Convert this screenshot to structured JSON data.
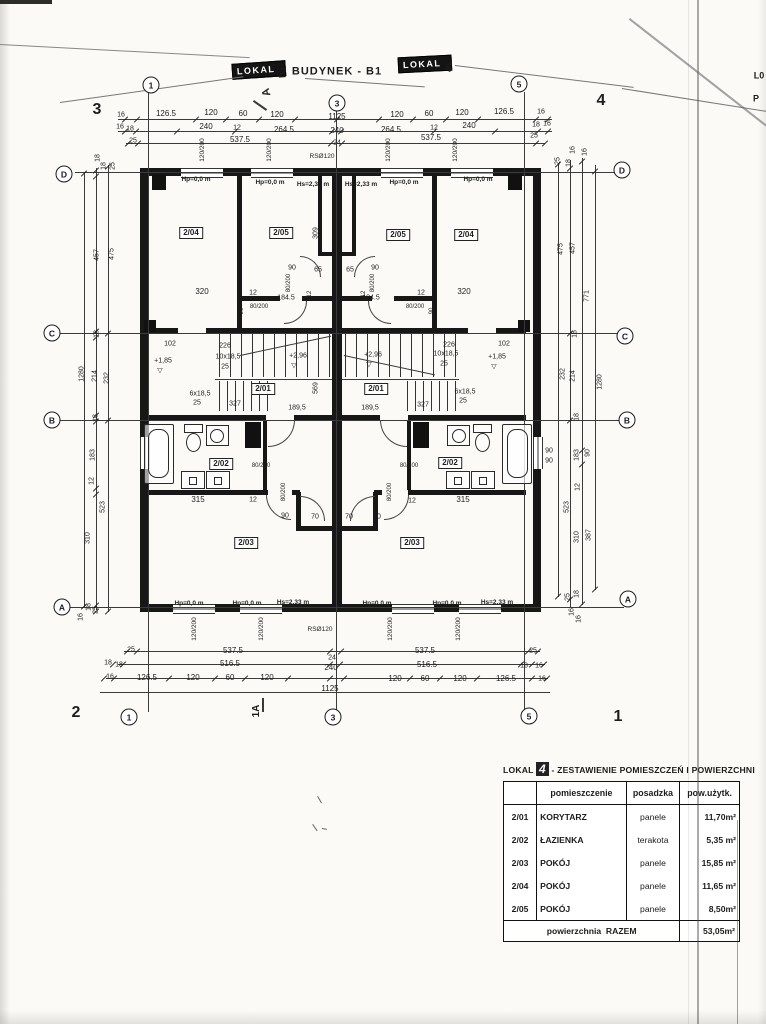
{
  "page": {
    "title": "BUDYNEK - B1"
  },
  "badges": {
    "left": {
      "word": "LOKAL",
      "num": "2"
    },
    "right": {
      "word": "LOKAL",
      "num": "4"
    }
  },
  "axes": [
    {
      "t": "1",
      "x": 151,
      "y": 85
    },
    {
      "t": "3",
      "x": 337,
      "y": 103
    },
    {
      "t": "5",
      "x": 519,
      "y": 84
    },
    {
      "t": "1",
      "x": 129,
      "y": 717
    },
    {
      "t": "3",
      "x": 333,
      "y": 717
    },
    {
      "t": "5",
      "x": 529,
      "y": 716
    },
    {
      "t": "D",
      "x": 64,
      "y": 174
    },
    {
      "t": "C",
      "x": 52,
      "y": 333
    },
    {
      "t": "B",
      "x": 52,
      "y": 420
    },
    {
      "t": "A",
      "x": 62,
      "y": 607
    },
    {
      "t": "D",
      "x": 622,
      "y": 170
    },
    {
      "t": "C",
      "x": 625,
      "y": 336
    },
    {
      "t": "B",
      "x": 627,
      "y": 420
    },
    {
      "t": "A",
      "x": 628,
      "y": 599
    }
  ],
  "table": {
    "title_prefix": "LOKAL",
    "title_num": "4",
    "title_rest": "- ZESTAWIENIE POMIESZCZEŃ I POWIERZCHNI",
    "headers": [
      "",
      "pomieszczenie",
      "posadzka",
      "pow.użytk."
    ],
    "rows": [
      [
        "2/01",
        "KORYTARZ",
        "panele",
        "11,70m²"
      ],
      [
        "2/02",
        "ŁAZIENKA",
        "terakota",
        "5,35 m²"
      ],
      [
        "2/03",
        "POKÓJ",
        "panele",
        "15,85 m²"
      ],
      [
        "2/04",
        "POKÓJ",
        "panele",
        "11,65 m²"
      ],
      [
        "2/05",
        "POKÓJ",
        "panele",
        "8,50m²"
      ]
    ],
    "footer_label": "powierzchnia",
    "footer_label2": "RAZEM",
    "footer_value": "53,05m²"
  },
  "labels": [
    {
      "t": "3",
      "x": 97,
      "y": 110,
      "s": 16,
      "b": 1,
      "n": "page-corner-number"
    },
    {
      "t": "4",
      "x": 601,
      "y": 101,
      "s": 16,
      "b": 1,
      "n": "page-corner-number"
    },
    {
      "t": "2",
      "x": 76,
      "y": 713,
      "s": 16,
      "b": 1,
      "n": "page-corner-number"
    },
    {
      "t": "1",
      "x": 618,
      "y": 717,
      "s": 16,
      "b": 1,
      "n": "page-corner-number"
    },
    {
      "t": "A",
      "x": 267,
      "y": 92,
      "s": 11,
      "b": 1,
      "r": -105,
      "n": "section-marker"
    },
    {
      "t": "1A",
      "x": 257,
      "y": 711,
      "s": 10,
      "b": 1,
      "r": -90,
      "n": "section-marker"
    },
    {
      "t": "L0",
      "x": 759,
      "y": 76,
      "s": 9,
      "b": 1,
      "n": "clipped-edge-text"
    },
    {
      "t": "P",
      "x": 756,
      "y": 99,
      "s": 9,
      "b": 1,
      "n": "clipped-edge-text"
    },
    {
      "t": "16",
      "x": 121,
      "y": 115,
      "s": 7
    },
    {
      "t": "126.5",
      "x": 166,
      "y": 114
    },
    {
      "t": "120",
      "x": 211,
      "y": 113
    },
    {
      "t": "60",
      "x": 243,
      "y": 114
    },
    {
      "t": "120",
      "x": 277,
      "y": 115
    },
    {
      "t": "1125",
      "x": 337,
      "y": 117
    },
    {
      "t": "120",
      "x": 397,
      "y": 115
    },
    {
      "t": "60",
      "x": 429,
      "y": 114
    },
    {
      "t": "120",
      "x": 462,
      "y": 113
    },
    {
      "t": "126.5",
      "x": 504,
      "y": 112
    },
    {
      "t": "16",
      "x": 541,
      "y": 112,
      "s": 7
    },
    {
      "t": "16",
      "x": 120,
      "y": 127,
      "s": 7
    },
    {
      "t": "18",
      "x": 130,
      "y": 129,
      "s": 7
    },
    {
      "t": "240",
      "x": 206,
      "y": 127
    },
    {
      "t": "12",
      "x": 237,
      "y": 128,
      "s": 7
    },
    {
      "t": "264.5",
      "x": 284,
      "y": 130
    },
    {
      "t": "240",
      "x": 337,
      "y": 131
    },
    {
      "t": "264.5",
      "x": 391,
      "y": 130
    },
    {
      "t": "12",
      "x": 434,
      "y": 128,
      "s": 7
    },
    {
      "t": "240",
      "x": 469,
      "y": 126
    },
    {
      "t": "18",
      "x": 536,
      "y": 125,
      "s": 7
    },
    {
      "t": "16",
      "x": 547,
      "y": 124,
      "s": 7
    },
    {
      "t": "25",
      "x": 133,
      "y": 141,
      "s": 7
    },
    {
      "t": "537.5",
      "x": 240,
      "y": 140
    },
    {
      "t": "24",
      "x": 337,
      "y": 143,
      "s": 7
    },
    {
      "t": "537.5",
      "x": 431,
      "y": 138
    },
    {
      "t": "25",
      "x": 534,
      "y": 136,
      "s": 7
    },
    {
      "t": "RSØ120",
      "x": 322,
      "y": 157,
      "s": 6.5
    },
    {
      "t": "RSØ120",
      "x": 320,
      "y": 630,
      "s": 6.5
    },
    {
      "t": "120/200",
      "x": 203,
      "y": 150,
      "r": -90,
      "s": 6.5
    },
    {
      "t": "120/200",
      "x": 270,
      "y": 150,
      "r": -90,
      "s": 6.5
    },
    {
      "t": "120/200",
      "x": 389,
      "y": 150,
      "r": -90,
      "s": 6.5
    },
    {
      "t": "120/200",
      "x": 456,
      "y": 150,
      "r": -90,
      "s": 6.5
    },
    {
      "t": "120/200",
      "x": 195,
      "y": 629,
      "r": -90,
      "s": 6.5
    },
    {
      "t": "120/200",
      "x": 262,
      "y": 629,
      "r": -90,
      "s": 6.5
    },
    {
      "t": "120/200",
      "x": 391,
      "y": 629,
      "r": -90,
      "s": 6.5
    },
    {
      "t": "120/200",
      "x": 459,
      "y": 629,
      "r": -90,
      "s": 6.5
    },
    {
      "t": "Hp=0,0 m",
      "x": 196,
      "y": 180,
      "s": 6.5,
      "b": 1
    },
    {
      "t": "Hp=0,0 m",
      "x": 270,
      "y": 183,
      "s": 6.5,
      "b": 1
    },
    {
      "t": "Hs=2,33 m",
      "x": 313,
      "y": 185,
      "s": 6.5,
      "b": 1
    },
    {
      "t": "Hs=2,33 m",
      "x": 361,
      "y": 185,
      "s": 6.5,
      "b": 1
    },
    {
      "t": "Hp=0,0 m",
      "x": 404,
      "y": 183,
      "s": 6.5,
      "b": 1
    },
    {
      "t": "Hp=0,0 m",
      "x": 478,
      "y": 180,
      "s": 6.5,
      "b": 1
    },
    {
      "t": "Hp=0,0 m",
      "x": 189,
      "y": 604,
      "s": 6.5,
      "b": 1
    },
    {
      "t": "Hp=0,0 m",
      "x": 247,
      "y": 604,
      "s": 6.5,
      "b": 1
    },
    {
      "t": "Hs=2,33 m",
      "x": 293,
      "y": 603,
      "s": 6.5,
      "b": 1
    },
    {
      "t": "Hp=0,0 m",
      "x": 377,
      "y": 604,
      "s": 6.5,
      "b": 1
    },
    {
      "t": "Hp=0,0 m",
      "x": 447,
      "y": 604,
      "s": 6.5,
      "b": 1
    },
    {
      "t": "Hs=2,33 m",
      "x": 497,
      "y": 603,
      "s": 6.5,
      "b": 1
    },
    {
      "t": "2/04",
      "x": 191,
      "y": 233,
      "box": 1,
      "n": "room-label"
    },
    {
      "t": "2/05",
      "x": 281,
      "y": 233,
      "box": 1,
      "n": "room-label"
    },
    {
      "t": "2/05",
      "x": 398,
      "y": 235,
      "box": 1,
      "n": "room-label"
    },
    {
      "t": "2/04",
      "x": 466,
      "y": 235,
      "box": 1,
      "n": "room-label"
    },
    {
      "t": "2/01",
      "x": 263,
      "y": 389,
      "box": 1,
      "n": "room-label"
    },
    {
      "t": "2/01",
      "x": 376,
      "y": 389,
      "box": 1,
      "n": "room-label"
    },
    {
      "t": "2/02",
      "x": 221,
      "y": 464,
      "box": 1,
      "n": "room-label"
    },
    {
      "t": "2/02",
      "x": 450,
      "y": 463,
      "box": 1,
      "n": "room-label"
    },
    {
      "t": "2/03",
      "x": 246,
      "y": 543,
      "box": 1,
      "n": "room-label"
    },
    {
      "t": "2/03",
      "x": 412,
      "y": 543,
      "box": 1,
      "n": "room-label"
    },
    {
      "t": "309",
      "x": 316,
      "y": 233,
      "r": -90,
      "s": 7
    },
    {
      "t": "90",
      "x": 292,
      "y": 268,
      "s": 7
    },
    {
      "t": "65",
      "x": 318,
      "y": 270,
      "s": 7
    },
    {
      "t": "65",
      "x": 350,
      "y": 270,
      "s": 7
    },
    {
      "t": "90",
      "x": 375,
      "y": 268,
      "s": 7
    },
    {
      "t": "80/200",
      "x": 289,
      "y": 283,
      "r": -90,
      "s": 6
    },
    {
      "t": "80/200",
      "x": 373,
      "y": 283,
      "r": -90,
      "s": 6
    },
    {
      "t": "320",
      "x": 202,
      "y": 292
    },
    {
      "t": "12",
      "x": 253,
      "y": 293,
      "s": 7
    },
    {
      "t": "12",
      "x": 310,
      "y": 294,
      "r": -90,
      "s": 6
    },
    {
      "t": "12",
      "x": 364,
      "y": 294,
      "r": -90,
      "s": 6
    },
    {
      "t": "12",
      "x": 421,
      "y": 293,
      "s": 7
    },
    {
      "t": "320",
      "x": 464,
      "y": 292
    },
    {
      "t": "184.5",
      "x": 286,
      "y": 298,
      "s": 7
    },
    {
      "t": "184.5",
      "x": 371,
      "y": 298,
      "s": 7
    },
    {
      "t": "90",
      "x": 242,
      "y": 311,
      "r": -90,
      "s": 6
    },
    {
      "t": "80/200",
      "x": 259,
      "y": 307,
      "s": 6
    },
    {
      "t": "80/200",
      "x": 415,
      "y": 307,
      "s": 6
    },
    {
      "t": "90",
      "x": 432,
      "y": 311,
      "r": -90,
      "s": 6
    },
    {
      "t": "102",
      "x": 170,
      "y": 344,
      "s": 7
    },
    {
      "t": "226",
      "x": 225,
      "y": 346,
      "s": 7
    },
    {
      "t": "10x18,5",
      "x": 228,
      "y": 357,
      "s": 7
    },
    {
      "t": "25",
      "x": 225,
      "y": 367,
      "s": 7
    },
    {
      "t": "+1,85",
      "x": 163,
      "y": 361,
      "s": 7
    },
    {
      "t": "▽",
      "x": 160,
      "y": 371,
      "s": 7
    },
    {
      "t": "6x18,5",
      "x": 200,
      "y": 394,
      "s": 7
    },
    {
      "t": "25",
      "x": 197,
      "y": 403,
      "s": 7
    },
    {
      "t": "327",
      "x": 235,
      "y": 404,
      "s": 7
    },
    {
      "t": "189,5",
      "x": 297,
      "y": 408,
      "s": 7
    },
    {
      "t": "+2,96",
      "x": 298,
      "y": 356,
      "s": 7
    },
    {
      "t": "▽",
      "x": 294,
      "y": 366,
      "s": 7
    },
    {
      "t": "+2,96",
      "x": 373,
      "y": 355,
      "s": 7
    },
    {
      "t": "▽",
      "x": 369,
      "y": 365,
      "s": 7
    },
    {
      "t": "569",
      "x": 316,
      "y": 388,
      "r": -90,
      "s": 7
    },
    {
      "t": "189,5",
      "x": 370,
      "y": 408,
      "s": 7
    },
    {
      "t": "327",
      "x": 423,
      "y": 405,
      "s": 7
    },
    {
      "t": "6x18,5",
      "x": 465,
      "y": 392,
      "s": 7
    },
    {
      "t": "25",
      "x": 463,
      "y": 401,
      "s": 7
    },
    {
      "t": "10x18,5",
      "x": 446,
      "y": 354,
      "s": 7
    },
    {
      "t": "25",
      "x": 444,
      "y": 364,
      "s": 7
    },
    {
      "t": "226",
      "x": 449,
      "y": 345,
      "s": 7
    },
    {
      "t": "102",
      "x": 504,
      "y": 344,
      "s": 7
    },
    {
      "t": "+1,85",
      "x": 497,
      "y": 357,
      "s": 7
    },
    {
      "t": "▽",
      "x": 494,
      "y": 367,
      "s": 7
    },
    {
      "t": "315",
      "x": 198,
      "y": 500
    },
    {
      "t": "12",
      "x": 253,
      "y": 500,
      "s": 7
    },
    {
      "t": "80/200",
      "x": 284,
      "y": 492,
      "r": -90,
      "s": 6
    },
    {
      "t": "80/200",
      "x": 261,
      "y": 466,
      "s": 6
    },
    {
      "t": "90",
      "x": 285,
      "y": 516,
      "s": 7
    },
    {
      "t": "70",
      "x": 315,
      "y": 517,
      "s": 7
    },
    {
      "t": "70",
      "x": 349,
      "y": 517,
      "s": 7
    },
    {
      "t": "90",
      "x": 377,
      "y": 517,
      "s": 7
    },
    {
      "t": "80/200",
      "x": 409,
      "y": 466,
      "s": 6
    },
    {
      "t": "80/200",
      "x": 390,
      "y": 492,
      "r": -90,
      "s": 6
    },
    {
      "t": "12",
      "x": 412,
      "y": 501,
      "s": 7
    },
    {
      "t": "315",
      "x": 463,
      "y": 500
    },
    {
      "t": "90",
      "x": 549,
      "y": 451,
      "s": 7
    },
    {
      "t": "90",
      "x": 549,
      "y": 461,
      "s": 7
    },
    {
      "t": "25",
      "x": 131,
      "y": 650,
      "s": 7
    },
    {
      "t": "537.5",
      "x": 233,
      "y": 651
    },
    {
      "t": "24",
      "x": 332,
      "y": 658,
      "s": 7
    },
    {
      "t": "537.5",
      "x": 425,
      "y": 651
    },
    {
      "t": "25",
      "x": 533,
      "y": 651,
      "s": 7
    },
    {
      "t": "18",
      "x": 108,
      "y": 663,
      "s": 7
    },
    {
      "t": "18",
      "x": 119,
      "y": 665,
      "s": 7
    },
    {
      "t": "516.5",
      "x": 230,
      "y": 664
    },
    {
      "t": "240",
      "x": 331,
      "y": 668
    },
    {
      "t": "516.5",
      "x": 427,
      "y": 665
    },
    {
      "t": "18",
      "x": 524,
      "y": 666,
      "s": 7
    },
    {
      "t": "16",
      "x": 539,
      "y": 666,
      "s": 7
    },
    {
      "t": "16",
      "x": 110,
      "y": 677,
      "s": 7
    },
    {
      "t": "126.5",
      "x": 147,
      "y": 678
    },
    {
      "t": "120",
      "x": 193,
      "y": 678
    },
    {
      "t": "60",
      "x": 230,
      "y": 678
    },
    {
      "t": "120",
      "x": 267,
      "y": 678
    },
    {
      "t": "1125",
      "x": 330,
      "y": 689
    },
    {
      "t": "120",
      "x": 395,
      "y": 679
    },
    {
      "t": "60",
      "x": 425,
      "y": 679
    },
    {
      "t": "120",
      "x": 460,
      "y": 679
    },
    {
      "t": "126.5",
      "x": 506,
      "y": 679
    },
    {
      "t": "16",
      "x": 542,
      "y": 679,
      "s": 7
    },
    {
      "t": "18",
      "x": 98,
      "y": 158,
      "r": -90,
      "s": 7
    },
    {
      "t": "18",
      "x": 104,
      "y": 166,
      "r": -90,
      "s": 7
    },
    {
      "t": "25",
      "x": 113,
      "y": 166,
      "r": -90,
      "s": 7
    },
    {
      "t": "457",
      "x": 97,
      "y": 255,
      "r": -90,
      "s": 7
    },
    {
      "t": "475",
      "x": 112,
      "y": 254,
      "r": -90,
      "s": 7
    },
    {
      "t": "18",
      "x": 97,
      "y": 334,
      "r": -90,
      "s": 7
    },
    {
      "t": "1280",
      "x": 82,
      "y": 374,
      "r": -90,
      "s": 7
    },
    {
      "t": "214",
      "x": 95,
      "y": 376,
      "r": -90,
      "s": 7
    },
    {
      "t": "232",
      "x": 107,
      "y": 378,
      "r": -90,
      "s": 7
    },
    {
      "t": "18",
      "x": 96,
      "y": 418,
      "r": -90,
      "s": 7
    },
    {
      "t": "183",
      "x": 93,
      "y": 455,
      "r": -90,
      "s": 7
    },
    {
      "t": "12",
      "x": 92,
      "y": 481,
      "r": -90,
      "s": 7
    },
    {
      "t": "523",
      "x": 103,
      "y": 507,
      "r": -90,
      "s": 7
    },
    {
      "t": "310",
      "x": 88,
      "y": 538,
      "r": -90,
      "s": 7
    },
    {
      "t": "18",
      "x": 89,
      "y": 607,
      "r": -90,
      "s": 7
    },
    {
      "t": "25",
      "x": 96,
      "y": 610,
      "r": -90,
      "s": 7
    },
    {
      "t": "16",
      "x": 81,
      "y": 617,
      "r": -90,
      "s": 7
    },
    {
      "t": "16",
      "x": 573,
      "y": 150,
      "r": -90,
      "s": 7
    },
    {
      "t": "16",
      "x": 585,
      "y": 152,
      "r": -90,
      "s": 7
    },
    {
      "t": "25",
      "x": 558,
      "y": 161,
      "r": -90,
      "s": 7
    },
    {
      "t": "18",
      "x": 569,
      "y": 163,
      "r": -90,
      "s": 7
    },
    {
      "t": "475",
      "x": 561,
      "y": 249,
      "r": -90,
      "s": 7
    },
    {
      "t": "457",
      "x": 573,
      "y": 248,
      "r": -90,
      "s": 7
    },
    {
      "t": "771",
      "x": 587,
      "y": 296,
      "r": -90,
      "s": 7
    },
    {
      "t": "18",
      "x": 575,
      "y": 334,
      "r": -90,
      "s": 7
    },
    {
      "t": "232",
      "x": 563,
      "y": 374,
      "r": -90,
      "s": 7
    },
    {
      "t": "214",
      "x": 573,
      "y": 376,
      "r": -90,
      "s": 7
    },
    {
      "t": "1280",
      "x": 600,
      "y": 382,
      "r": -90,
      "s": 7
    },
    {
      "t": "18",
      "x": 577,
      "y": 417,
      "r": -90,
      "s": 7
    },
    {
      "t": "183",
      "x": 577,
      "y": 455,
      "r": -90,
      "s": 7
    },
    {
      "t": "90",
      "x": 588,
      "y": 453,
      "r": -90,
      "s": 7
    },
    {
      "t": "12",
      "x": 578,
      "y": 487,
      "r": -90,
      "s": 7
    },
    {
      "t": "523",
      "x": 567,
      "y": 507,
      "r": -90,
      "s": 7
    },
    {
      "t": "310",
      "x": 577,
      "y": 537,
      "r": -90,
      "s": 7
    },
    {
      "t": "387",
      "x": 589,
      "y": 535,
      "r": -90,
      "s": 7
    },
    {
      "t": "25",
      "x": 568,
      "y": 597,
      "r": -90,
      "s": 7
    },
    {
      "t": "18",
      "x": 577,
      "y": 594,
      "r": -90,
      "s": 7
    },
    {
      "t": "16",
      "x": 572,
      "y": 612,
      "r": -90,
      "s": 7
    },
    {
      "t": "16",
      "x": 579,
      "y": 619,
      "r": -90,
      "s": 7
    }
  ]
}
